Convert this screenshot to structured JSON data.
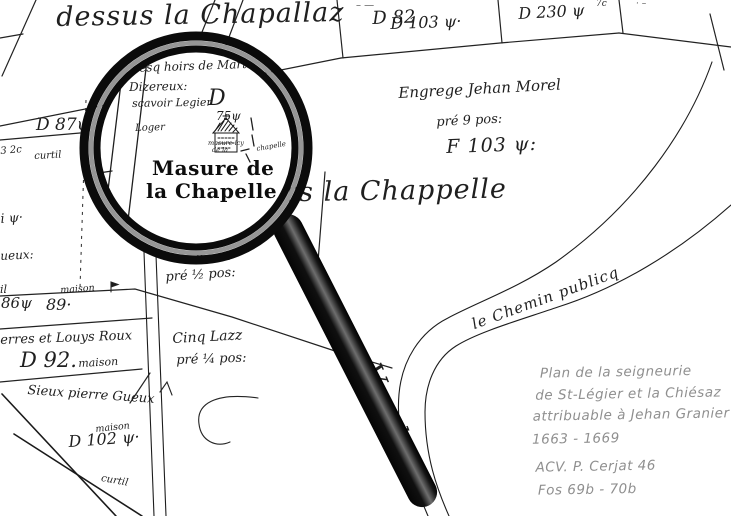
{
  "colors": {
    "ink": "#1f1f1f",
    "pencil": "#8f8f8f",
    "paper": "#ffffff",
    "rim_black": "#0b0b0b",
    "rim_gray": "#969696"
  },
  "top": {
    "title": "dessus la Chapallaz",
    "marks_left": "– —",
    "d82": "D 82",
    "d103": "D 103 ψ·",
    "d230": "D 230 ψ",
    "d230_sup": "7c",
    "marks_right": "· –"
  },
  "left": {
    "d87": "D 87ψ",
    "frag_32": "3 2c",
    "curtil_top": "curtil",
    "frag_psi": "i ψ·",
    "frag_ueux": "ueux:",
    "frag_il": "il",
    "maison_a": "maison",
    "n86": "86ψ",
    "n89": "89·",
    "roux": "erres et Louys Roux",
    "d92": "D 92.",
    "maison_b": "maison",
    "gueux": "Sieux pierre Gueux",
    "maison_c": "maison",
    "d102": "D 102 ψ·",
    "curtil_bottom": "curtil"
  },
  "center": {
    "vers": "Vers la Chappelle",
    "gueux_frag": "Gueux",
    "pre_half": "pré ½ pos:",
    "cinq": "Cinq Lazz",
    "pre_quarter": "pré ¼ pos:",
    "river": "Vaudeyre"
  },
  "right": {
    "morel_1": "Engrege Jehan Morel",
    "morel_2": "pré 9 pos:",
    "f103": "F 103 ψ:",
    "chemin": "le Chemin publicq"
  },
  "lens": {
    "l1": "Lesq hoirs de Martin",
    "l2": "Dizereux:",
    "l3": "scavoir Legier",
    "d": "D",
    "d_val": "75ψ",
    "loger": "Loger",
    "tiny_1": "masure icy",
    "tiny_2": "de la",
    "tiny_3": "chapelle",
    "label_1": "Masure de",
    "label_2": "la Chapelle"
  },
  "note": {
    "l1": "Plan de la seigneurie",
    "l2": "de St-Légier et  la Chiésaz",
    "l3": "attribuable à Jehan Granier",
    "l4": "1663 - 1669",
    "l5": "ACV. P. Cerjat 46",
    "l6": "Fos 69b - 70b"
  }
}
